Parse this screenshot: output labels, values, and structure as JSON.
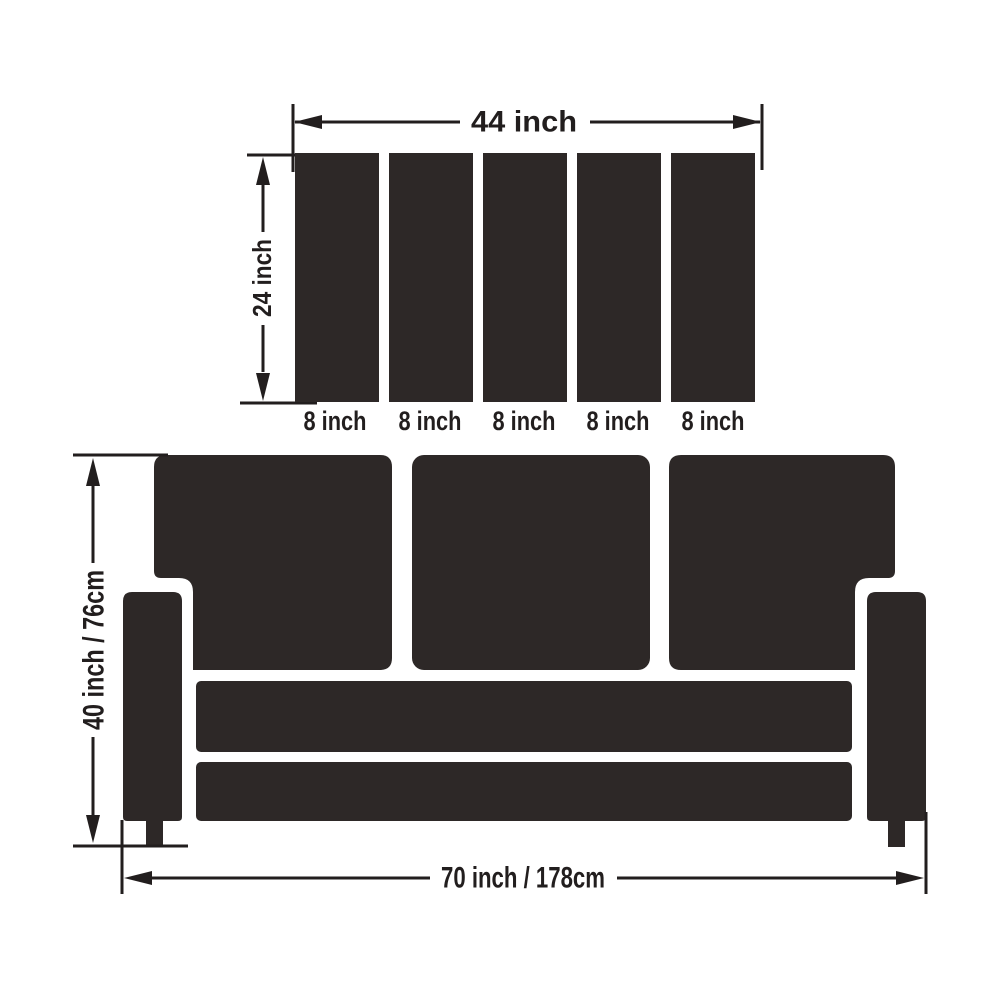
{
  "diagram": {
    "colors": {
      "shape_fill": "#2d2827",
      "line": "#221e1e",
      "text": "#221e1e",
      "background": "#ffffff"
    },
    "back_panel_view": {
      "width_label": "44 inch",
      "height_label": "24 inch",
      "slat_count": 5,
      "slat_labels": [
        "8 inch",
        "8 inch",
        "8 inch",
        "8 inch",
        "8 inch"
      ]
    },
    "sofa_front_view": {
      "back_cushion_count": 3,
      "height_label": "40 inch / 76cm",
      "width_label": "70 inch / 178cm"
    }
  }
}
